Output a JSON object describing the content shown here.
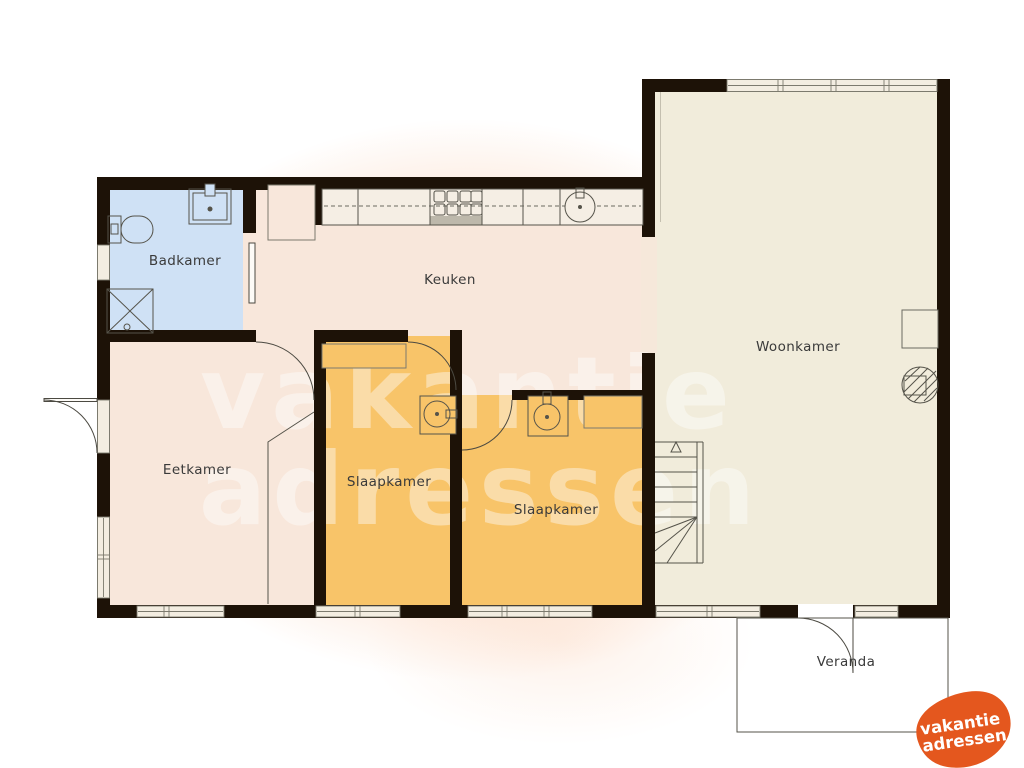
{
  "rooms": {
    "badkamer": "Badkamer",
    "keuken": "Keuken",
    "woonkamer": "Woonkamer",
    "eetkamer": "Eetkamer",
    "slaapkamer1": "Slaapkamer",
    "slaapkamer2": "Slaapkamer",
    "veranda": "Veranda"
  },
  "watermark": {
    "line1": "vakantie",
    "line2": "adressen"
  },
  "logo": {
    "line1": "vakantie",
    "line2": "adressen"
  },
  "colors": {
    "wall": "#1d1207",
    "bathroom_floor": "#cfe1f5",
    "kitchen_floor": "#f8e7db",
    "bedroom_floor": "#f8c469",
    "livingroom_floor": "#f1ecdb",
    "window_fill": "#f3ede1",
    "window_frame": "#7c7a6e",
    "fixture_line": "#4c4a42",
    "logo_orange": "#e4571e",
    "watermark_white": "#ffffff"
  },
  "fixtures": {
    "bathroom": [
      "toilet",
      "washbasin",
      "shower"
    ],
    "kitchen": [
      "counter",
      "hob",
      "round-sink",
      "cupboard"
    ],
    "bedroom1": [
      "closet",
      "washbasin"
    ],
    "bedroom2": [
      "washbasin",
      "shelf"
    ],
    "livingroom": [
      "wall-cabinet",
      "wood-stove",
      "staircase-up"
    ]
  }
}
